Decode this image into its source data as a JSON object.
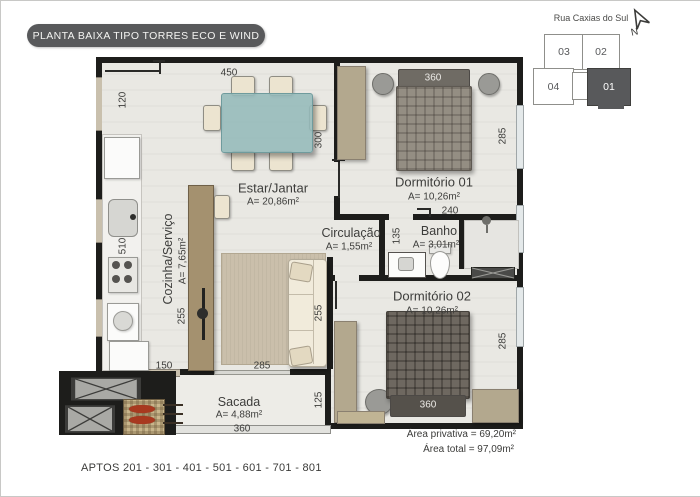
{
  "title": "PLANTA BAIXA TIPO TORRES ECO E WIND",
  "key_plan": {
    "street": "Rua Caxias do Sul",
    "north": "N",
    "units": [
      {
        "label": "03"
      },
      {
        "label": "02"
      },
      {
        "label": "04"
      },
      {
        "label": "01"
      }
    ],
    "highlighted_unit": "01"
  },
  "rooms": {
    "estar": {
      "name": "Estar/Jantar",
      "area": "A= 20,86m²"
    },
    "dorm1": {
      "name": "Dormitório 01",
      "area": "A= 10,26m²"
    },
    "circulacao": {
      "name": "Circulação",
      "area": "A= 1,55m²"
    },
    "banho": {
      "name": "Banho",
      "area": "A= 3,01m²"
    },
    "cozinha": {
      "name": "Cozinha/Serviço",
      "area": "A= 7,65m²"
    },
    "dorm2": {
      "name": "Dormitório 02",
      "area": "A= 10,26m²"
    },
    "sacada": {
      "name": "Sacada",
      "area": "A= 4,88m²"
    }
  },
  "dimensions": {
    "d450": "450",
    "d120": "120",
    "d300": "300",
    "d360_dorm1": "360",
    "d285_dorm1": "285",
    "d240": "240",
    "d135": "135",
    "d510": "510",
    "d255_left": "255",
    "d255_right": "255",
    "d285_living": "285",
    "d150": "150",
    "d285_dorm2": "285",
    "d125": "125",
    "d360_sacada": "360",
    "d360_dorm2": "360"
  },
  "summary": {
    "area_privativa": "Área privativa = 69,20m²",
    "area_total": "Área total = 97,09m²"
  },
  "footer": {
    "aptos": "APTOS 201 - 301 - 401 - 501 - 601 - 701 - 801"
  },
  "colors": {
    "accent": "#58595b",
    "wall": "#1d1d1b",
    "wood": "#b3a88e",
    "glass_table": "#94b9ba"
  }
}
